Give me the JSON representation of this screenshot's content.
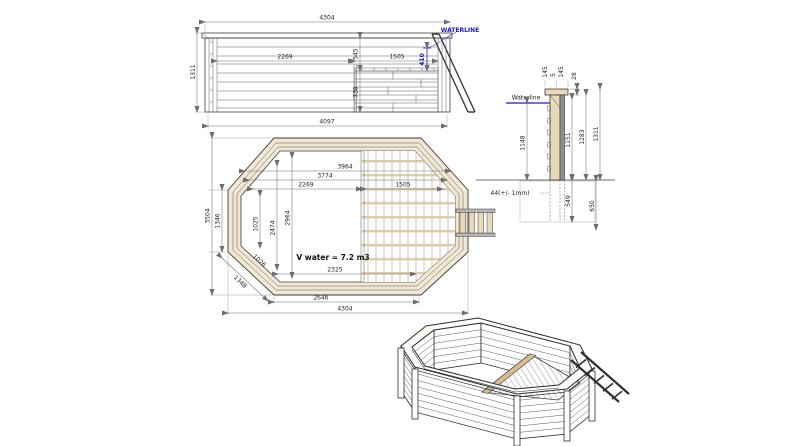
{
  "drawing": {
    "front_view": {
      "waterline_label": "WATERLINE",
      "overall_width": "4304",
      "overall_height": "1311",
      "base_width": "4097",
      "inner_width_left": "2269",
      "upper_height": "545",
      "deck_width": "1505",
      "waterline_depth": "410",
      "lower_height": "738"
    },
    "wall_section": {
      "waterline_label": "Waterline",
      "board_width_a": "145",
      "board_gap": "5",
      "board_width_b": "145",
      "coping_thickness": "28",
      "water_depth": "1148",
      "height_inner": "1151",
      "height_boards": "1283",
      "height_total": "1311",
      "wall_thickness": "44(+/- 1mm)",
      "post_depth": "549",
      "footing_depth": "650"
    },
    "plan_view": {
      "overall_width": "4304",
      "overall_height": "3504",
      "bottom_edge": "2646",
      "inner_bottom": "2325",
      "side_length": "1346",
      "corner_length": "1348",
      "inner_corner": "1026",
      "inner_side": "1025",
      "inner_span_a": "2474",
      "inner_span_b": "2964",
      "inner_width_a": "2269",
      "inner_width_b": "3774",
      "inner_width_c": "3964",
      "deck_width": "1505",
      "volume_note": "V water = 7.2 m3"
    },
    "colors": {
      "waterline_blue": "#1a1acd",
      "wood_tan": "#ead9b8",
      "line_dark": "#3c3c3c"
    }
  }
}
